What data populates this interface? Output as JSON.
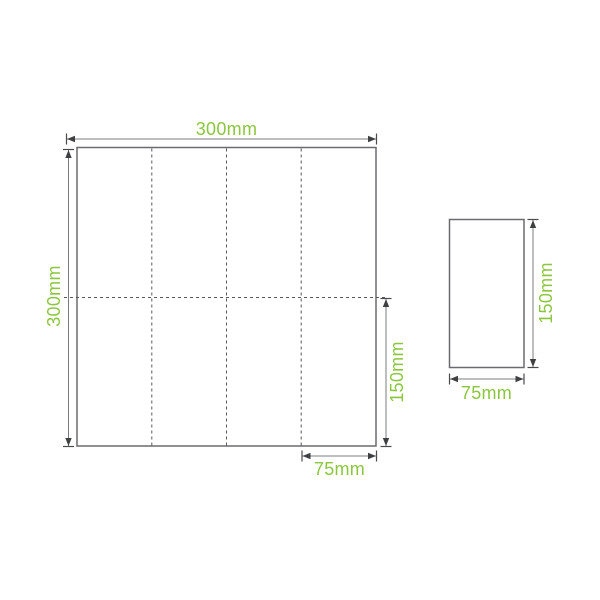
{
  "diagram": {
    "accent_color": "#8CC63F",
    "line_color": "#7B7C7F",
    "unfolded_napkin": {
      "width_label": "300mm",
      "height_label": "300mm",
      "fold_height_label": "150mm",
      "fold_width_label": "75mm",
      "vertical_fold_lines": 3,
      "horizontal_fold_lines": 1
    },
    "folded_napkin": {
      "height_label": "150mm",
      "width_label": "75mm"
    }
  }
}
